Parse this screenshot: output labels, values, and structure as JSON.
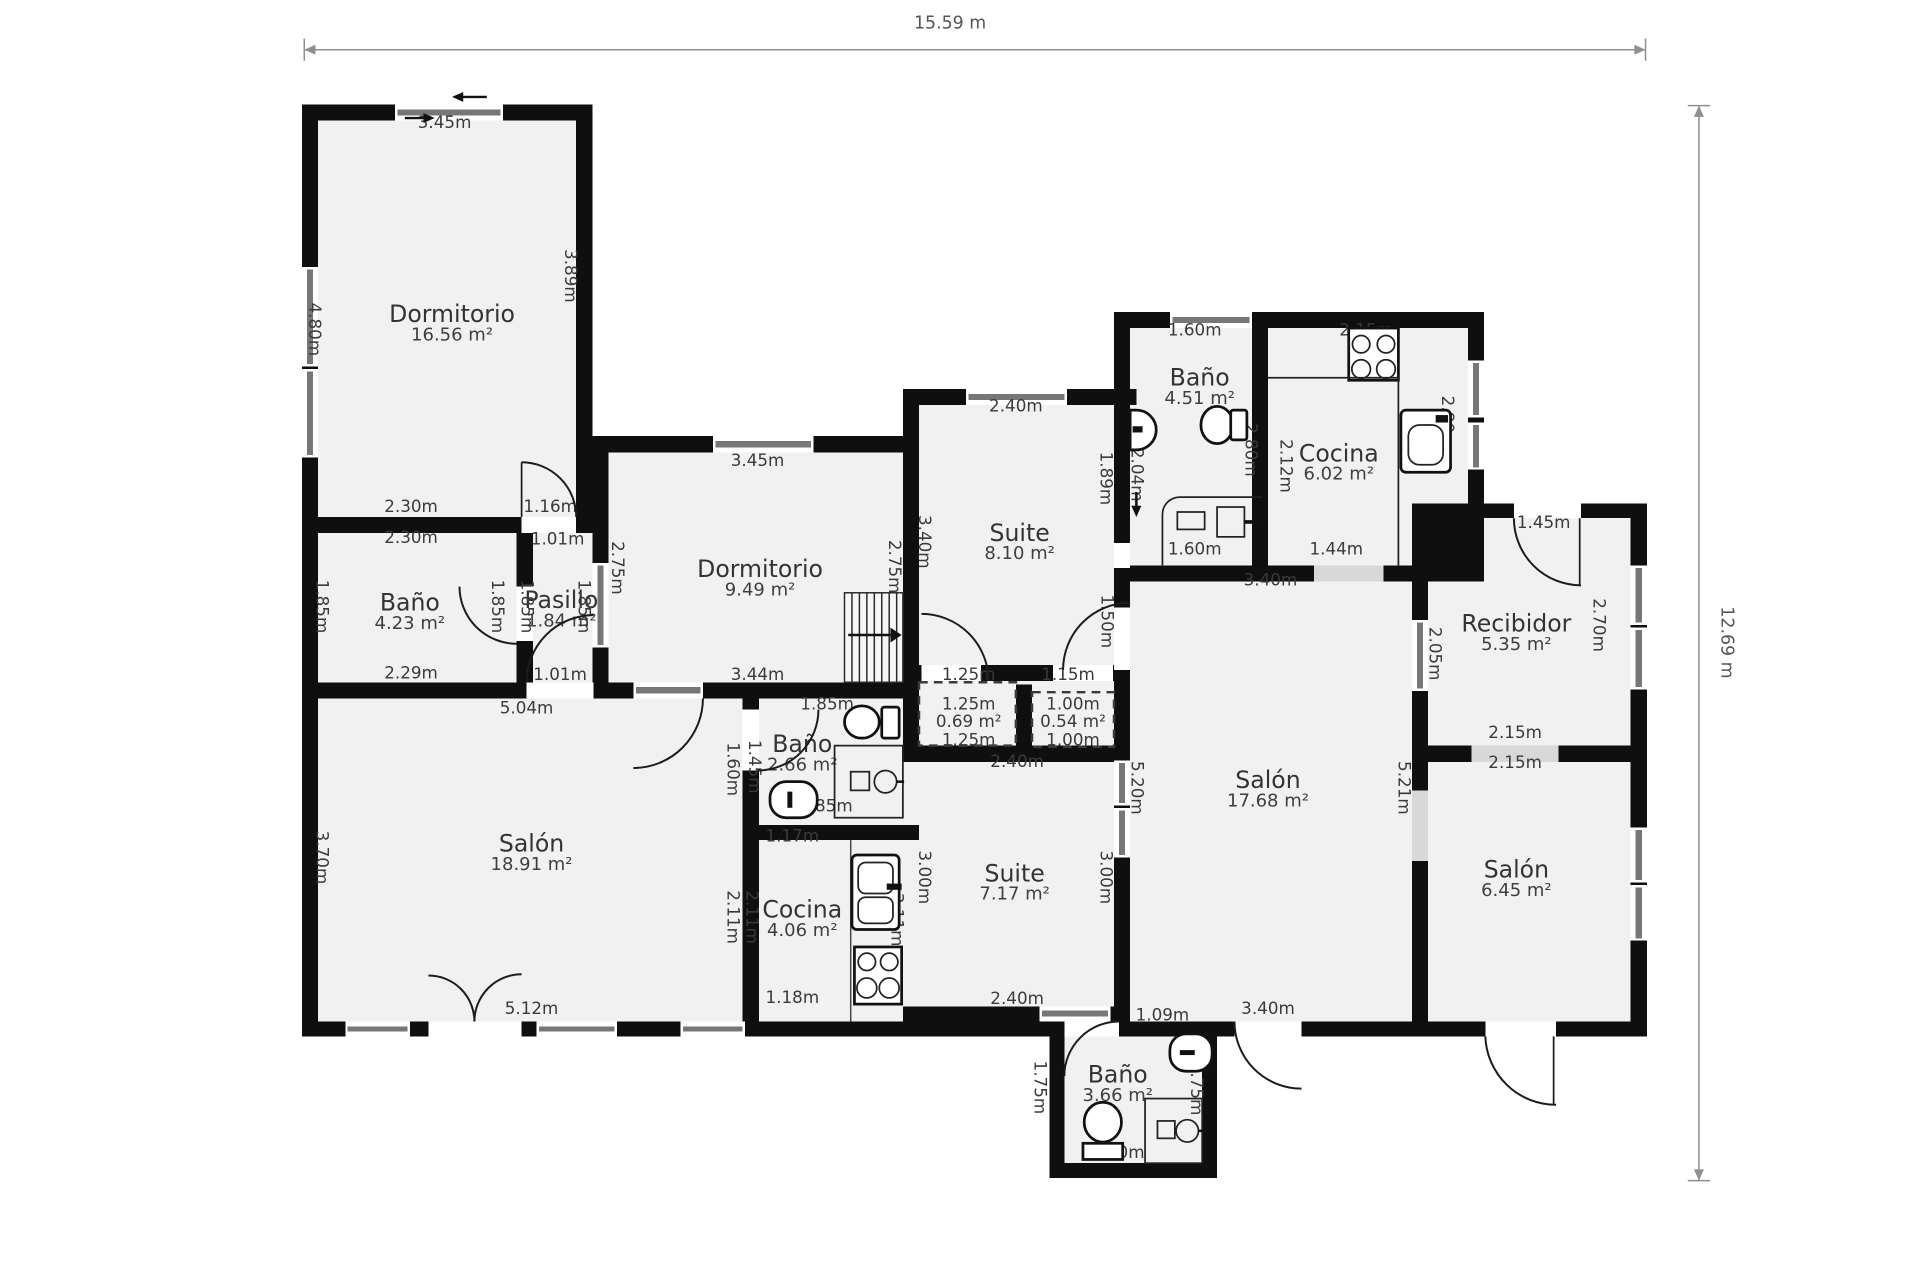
{
  "rulers": {
    "top_label": "15.59 m",
    "right_label": "12.69 m"
  },
  "colors": {
    "wall": "#0f0f0f",
    "room_fill": "#f1f1f1",
    "opening": "#d8d8d8",
    "text": "#3a3a3a"
  },
  "rooms": [
    {
      "name": "Dormitorio",
      "area": "16.56 m²",
      "x": 364,
      "y": 254
    },
    {
      "name": "Baño",
      "area": "4.23 m²",
      "x": 330,
      "y": 486
    },
    {
      "name": "Pasillo",
      "area": "1.84 m²",
      "x": 452,
      "y": 484
    },
    {
      "name": "Dormitorio",
      "area": "9.49 m²",
      "x": 612,
      "y": 459
    },
    {
      "name": "Suite",
      "area": "8.10 m²",
      "x": 821,
      "y": 430
    },
    {
      "name": "Baño",
      "area": "4.51 m²",
      "x": 966,
      "y": 305
    },
    {
      "name": "Cocina",
      "area": "6.02 m²",
      "x": 1078,
      "y": 366
    },
    {
      "name": "Recibidor",
      "area": "5.35 m²",
      "x": 1221,
      "y": 503
    },
    {
      "name": "Salón",
      "area": "17.68 m²",
      "x": 1021,
      "y": 629
    },
    {
      "name": "Salón",
      "area": "18.91 m²",
      "x": 428,
      "y": 680
    },
    {
      "name": "Baño",
      "area": "2.66 m²",
      "x": 646,
      "y": 600
    },
    {
      "name": "Cocina",
      "area": "4.06 m²",
      "x": 646,
      "y": 733
    },
    {
      "name": "Suite",
      "area": "7.17 m²",
      "x": 817,
      "y": 704
    },
    {
      "name": "Salón",
      "area": "6.45 m²",
      "x": 1221,
      "y": 701
    },
    {
      "name": "Baño",
      "area": "3.66 m²",
      "x": 900,
      "y": 866
    }
  ],
  "measurements": [
    {
      "t": "3.45m",
      "x": 358,
      "y": 99,
      "r": 0
    },
    {
      "t": "4.80m",
      "x": 253,
      "y": 265,
      "r": 90
    },
    {
      "t": "3.89m",
      "x": 459,
      "y": 222,
      "r": 90
    },
    {
      "t": "2.30m",
      "x": 331,
      "y": 408,
      "r": 0
    },
    {
      "t": "2.30m",
      "x": 331,
      "y": 433,
      "r": 0
    },
    {
      "t": "1.16m",
      "x": 443,
      "y": 408,
      "r": 0
    },
    {
      "t": "1.01m",
      "x": 449,
      "y": 434,
      "r": 0
    },
    {
      "t": "1.85m",
      "x": 259,
      "y": 488,
      "r": 90
    },
    {
      "t": "1.85m",
      "x": 400,
      "y": 488,
      "r": 90
    },
    {
      "t": "1.85m",
      "x": 424,
      "y": 488,
      "r": 90
    },
    {
      "t": "1.85m",
      "x": 470,
      "y": 488,
      "r": 90
    },
    {
      "t": "2.29m",
      "x": 331,
      "y": 542,
      "r": 0
    },
    {
      "t": "1.01m",
      "x": 451,
      "y": 543,
      "r": 0
    },
    {
      "t": "5.04m",
      "x": 424,
      "y": 570,
      "r": 0
    },
    {
      "t": "2.75m",
      "x": 497,
      "y": 457,
      "r": 90
    },
    {
      "t": "2.75m",
      "x": 720,
      "y": 456,
      "r": 90
    },
    {
      "t": "3.45m",
      "x": 610,
      "y": 371,
      "r": 0
    },
    {
      "t": "3.44m",
      "x": 610,
      "y": 543,
      "r": 0
    },
    {
      "t": "3.40m",
      "x": 744,
      "y": 436,
      "r": 90
    },
    {
      "t": "2.40m",
      "x": 818,
      "y": 327,
      "r": 0
    },
    {
      "t": "1.89m",
      "x": 890,
      "y": 385,
      "r": 90
    },
    {
      "t": "2.04m",
      "x": 915,
      "y": 382,
      "r": 90
    },
    {
      "t": "1.50m",
      "x": 891,
      "y": 500,
      "r": 90
    },
    {
      "t": "1.25m",
      "x": 780,
      "y": 543,
      "r": 0
    },
    {
      "t": "1.15m",
      "x": 860,
      "y": 543,
      "r": 0
    },
    {
      "t": "1.25m",
      "x": 780,
      "y": 567,
      "r": 0
    },
    {
      "t": "0.69 m²",
      "x": 780,
      "y": 581,
      "r": 0
    },
    {
      "t": "1.25m",
      "x": 780,
      "y": 596,
      "r": 0
    },
    {
      "t": "1.00m",
      "x": 864,
      "y": 567,
      "r": 0
    },
    {
      "t": "0.54 m²",
      "x": 864,
      "y": 581,
      "r": 0
    },
    {
      "t": "1.00m",
      "x": 864,
      "y": 596,
      "r": 0
    },
    {
      "t": "1.60m",
      "x": 962,
      "y": 266,
      "r": 0
    },
    {
      "t": "2.80m",
      "x": 1007,
      "y": 362,
      "r": 90
    },
    {
      "t": "1.60m",
      "x": 962,
      "y": 442,
      "r": 0
    },
    {
      "t": "2.15m",
      "x": 1100,
      "y": 266,
      "r": 0
    },
    {
      "t": "2.12m",
      "x": 1035,
      "y": 375,
      "r": 90
    },
    {
      "t": "2.80m",
      "x": 1165,
      "y": 340,
      "r": 90
    },
    {
      "t": "1.44m",
      "x": 1076,
      "y": 442,
      "r": 0
    },
    {
      "t": "3.40m",
      "x": 1023,
      "y": 467,
      "r": 0
    },
    {
      "t": "1.45m",
      "x": 1243,
      "y": 421,
      "r": 0
    },
    {
      "t": "2.05m",
      "x": 1155,
      "y": 526,
      "r": 90
    },
    {
      "t": "2.70m",
      "x": 1287,
      "y": 503,
      "r": 90
    },
    {
      "t": "2.15m",
      "x": 1220,
      "y": 590,
      "r": 0
    },
    {
      "t": "2.15m",
      "x": 1220,
      "y": 614,
      "r": 0
    },
    {
      "t": "5.20m",
      "x": 915,
      "y": 634,
      "r": 90
    },
    {
      "t": "5.21m",
      "x": 1130,
      "y": 634,
      "r": 90
    },
    {
      "t": "3.40m",
      "x": 1021,
      "y": 812,
      "r": 0
    },
    {
      "t": "3.70m",
      "x": 259,
      "y": 690,
      "r": 90
    },
    {
      "t": "5.12m",
      "x": 428,
      "y": 812,
      "r": 0
    },
    {
      "t": "1.85m",
      "x": 666,
      "y": 567,
      "r": 0
    },
    {
      "t": "1.45m",
      "x": 607,
      "y": 617,
      "r": 90
    },
    {
      "t": "1.60m",
      "x": 590,
      "y": 619,
      "r": 90
    },
    {
      "t": "1.85m",
      "x": 665,
      "y": 649,
      "r": 0
    },
    {
      "t": "1.17m",
      "x": 638,
      "y": 673,
      "r": 0
    },
    {
      "t": "2.11m",
      "x": 590,
      "y": 738,
      "r": 90
    },
    {
      "t": "2.11m",
      "x": 605,
      "y": 738,
      "r": 90
    },
    {
      "t": "3.11m",
      "x": 722,
      "y": 740,
      "r": 90
    },
    {
      "t": "1.18m",
      "x": 638,
      "y": 803,
      "r": 0
    },
    {
      "t": "2.40m",
      "x": 819,
      "y": 613,
      "r": 0
    },
    {
      "t": "3.00m",
      "x": 744,
      "y": 706,
      "r": 90
    },
    {
      "t": "3.00m",
      "x": 890,
      "y": 706,
      "r": 90
    },
    {
      "t": "2.40m",
      "x": 819,
      "y": 804,
      "r": 0
    },
    {
      "t": "1.09m",
      "x": 936,
      "y": 817,
      "r": 0
    },
    {
      "t": "1.75m",
      "x": 837,
      "y": 875,
      "r": 90
    },
    {
      "t": "1.75m",
      "x": 963,
      "y": 876,
      "r": 90
    },
    {
      "t": "2.10m",
      "x": 900,
      "y": 928,
      "r": 0
    }
  ]
}
